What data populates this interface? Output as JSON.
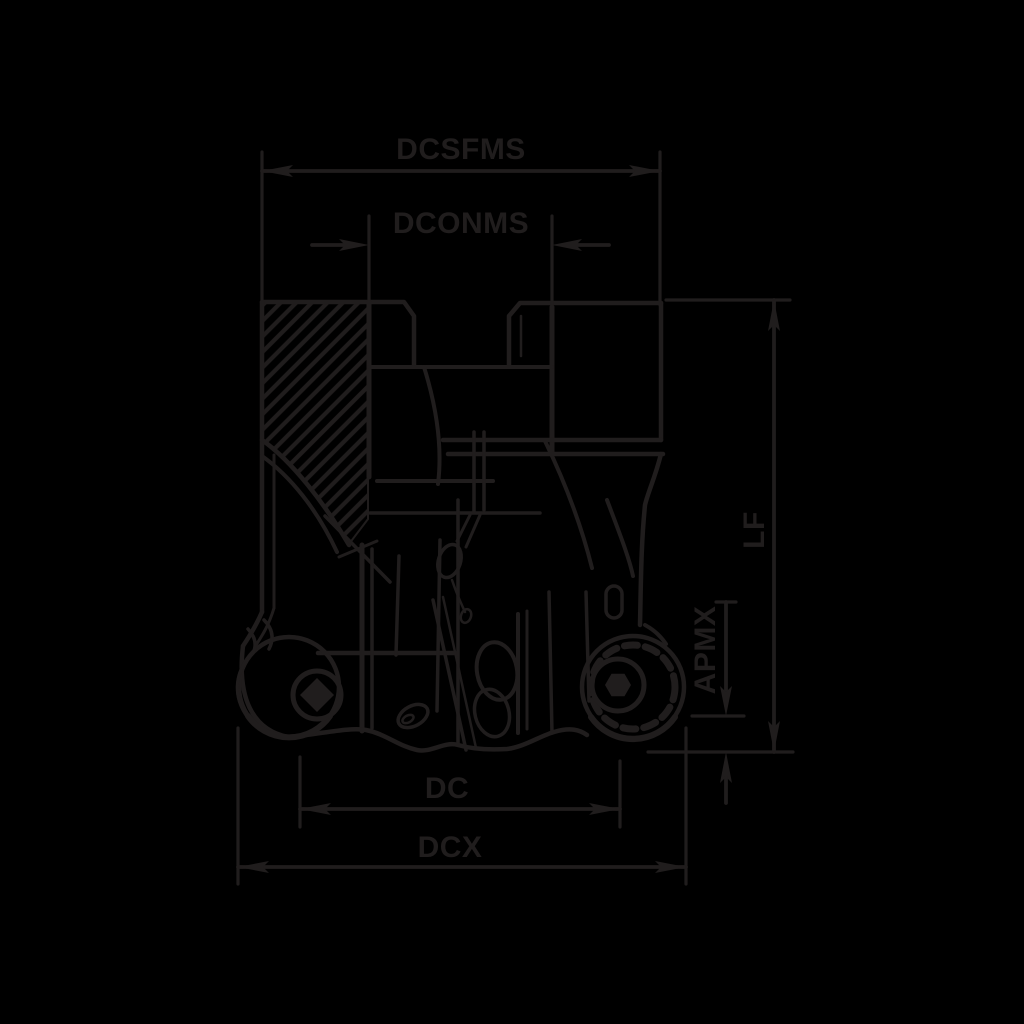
{
  "page": {
    "background_color": "#000000"
  },
  "drawing": {
    "kind": "technical-dimension-drawing",
    "subject": "round-insert face milling cutter, side elevation with half section",
    "stroke_color": "#201d1d",
    "labels": {
      "dcsfms": "DCSFMS",
      "dconms": "DCONMS",
      "lf": "LF",
      "apmx": "APMX",
      "dc": "DC",
      "dcx": "DCX"
    }
  }
}
